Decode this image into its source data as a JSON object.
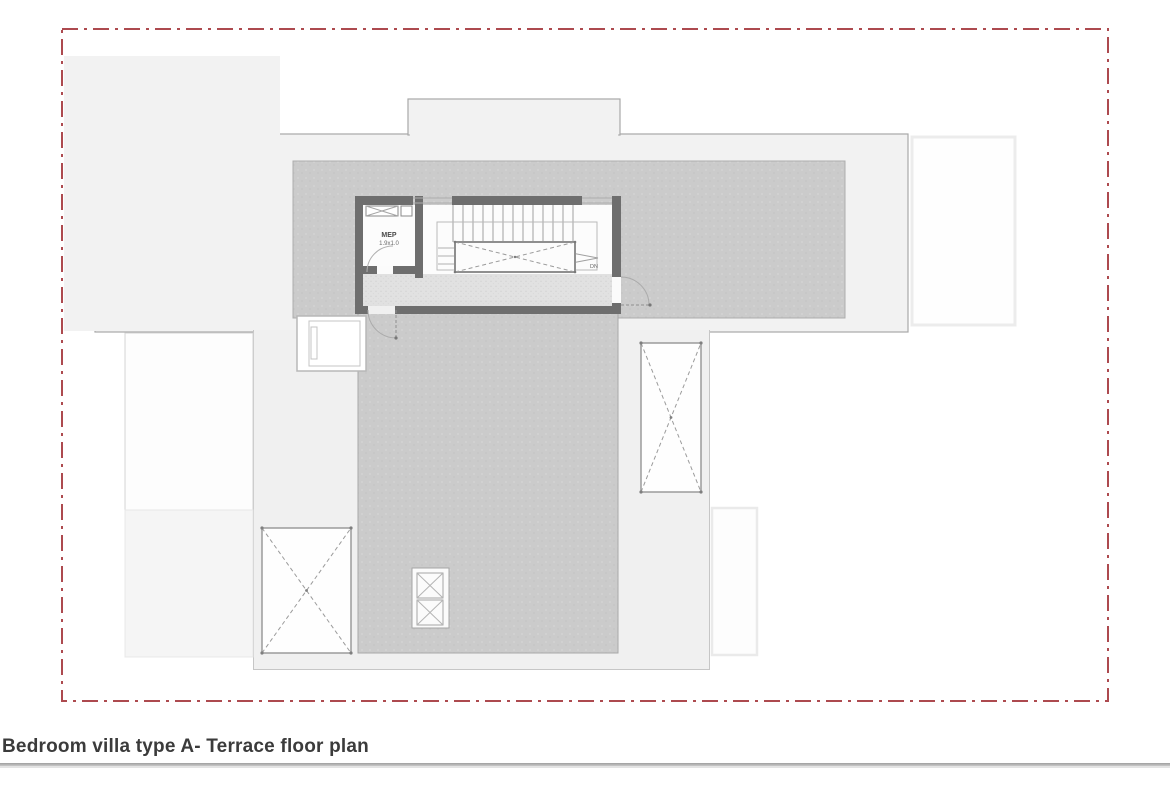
{
  "title": "Bedroom villa type A- Terrace floor plan",
  "rooms": {
    "mep": {
      "name": "MEP",
      "size": "1.9x1.0"
    }
  },
  "stair": {
    "down_label": "DN"
  },
  "colors": {
    "boundary_red": "#ad4a4f",
    "wall_gray": "#6e6e6e",
    "roof_light": "#f2f2f2",
    "roof_mid": "#cbcbcb",
    "terrace_mid": "#c9c9c9",
    "deck_light": "#f0f0f0",
    "floor_speckle": "#e1e1e1",
    "title_text": "#3b3b3b"
  }
}
